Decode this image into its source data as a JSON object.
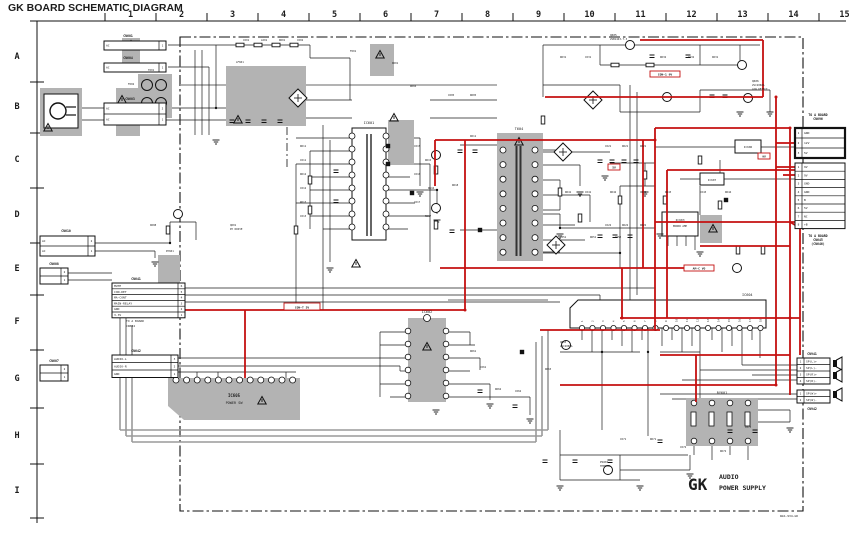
{
  "title": "GK BOARD SCHEMATIC DIAGRAM",
  "grid": {
    "columns": [
      "1",
      "2",
      "3",
      "4",
      "5",
      "6",
      "7",
      "8",
      "9",
      "10",
      "11",
      "12",
      "13",
      "14",
      "15"
    ],
    "rows": [
      "A",
      "B",
      "C",
      "D",
      "E",
      "F",
      "G",
      "H",
      "I"
    ]
  },
  "footer": {
    "board_code": "GK",
    "line1": "AUDIO",
    "line2": "POWER SUPPLY",
    "doc_number": "WGS-934-GK"
  },
  "colors": {
    "red_trace": "#c41111",
    "gray_trace": "#9a9a9a",
    "block_fill": "#b3b3b3",
    "wire": "#1c1c1c",
    "title_ink": "#1a1a40"
  },
  "red_labels": [
    {
      "x": 650,
      "y": 71,
      "w": 30,
      "h": 6,
      "text": "CON-1 9V"
    },
    {
      "x": 284,
      "y": 303,
      "w": 36,
      "h": 7,
      "text": "CON-T 5V"
    },
    {
      "x": 684,
      "y": 265,
      "w": 30,
      "h": 6,
      "text": "AM-C VO"
    },
    {
      "x": 608,
      "y": 164,
      "w": 12,
      "h": 6,
      "text": "5V"
    },
    {
      "x": 758,
      "y": 153,
      "w": 12,
      "h": 6,
      "text": "9V"
    }
  ],
  "connector_boxes": [
    {
      "caption": [
        "CN601"
      ],
      "capx": 128,
      "capy": 37,
      "x": 104,
      "y": 41,
      "w": 62,
      "rh": 9,
      "rows": [
        "AC"
      ],
      "numside": "right",
      "bold": false
    },
    {
      "caption": [
        "CN604"
      ],
      "capx": 128,
      "capy": 59,
      "x": 104,
      "y": 63,
      "w": 62,
      "rh": 9,
      "rows": [
        "AC"
      ],
      "numside": "right",
      "bold": false
    },
    {
      "caption": [
        "CN603"
      ],
      "capx": 130,
      "capy": 100,
      "x": 104,
      "y": 103,
      "w": 62,
      "rh": 11,
      "rows": [
        "AC",
        "AC"
      ],
      "numside": "right",
      "bold": false
    },
    {
      "caption": [
        "CN610"
      ],
      "capx": 66,
      "capy": 232,
      "x": 40,
      "y": 236,
      "w": 55,
      "rh": 10,
      "rows": [
        "AC",
        "AC"
      ],
      "numside": "right",
      "bold": false
    },
    {
      "caption": [
        "CN608"
      ],
      "capx": 54,
      "capy": 265,
      "x": 40,
      "y": 268,
      "w": 28,
      "rh": 8,
      "rows": [
        "",
        ""
      ],
      "numside": "right",
      "bold": false
    },
    {
      "caption": [
        "CN607"
      ],
      "capx": 54,
      "capy": 362,
      "x": 40,
      "y": 365,
      "w": 28,
      "rh": 8,
      "rows": [
        "",
        ""
      ],
      "numside": "right",
      "bold": false
    },
    {
      "caption": [
        "CN641"
      ],
      "capx": 136,
      "capy": 280,
      "x": 112,
      "y": 283,
      "w": 73,
      "rh": 5.8,
      "rows": [
        "MUTE",
        "CON-DET",
        "MA-CONT",
        "MAIN-RELAY",
        "GND",
        "3.3V"
      ],
      "numside": "right",
      "bold": false
    },
    {
      "caption": [
        "CN642"
      ],
      "capx": 136,
      "capy": 352,
      "x": 112,
      "y": 355,
      "w": 66,
      "rh": 7.5,
      "rows": [
        "AUDIO-L",
        "AUDIO-R",
        "GND"
      ],
      "numside": "right",
      "bold": false
    },
    {
      "caption": [
        "TO A BOARD",
        "CN696"
      ],
      "capx": 818,
      "capy": 116,
      "x": 795,
      "y": 128,
      "w": 50,
      "rh": 10,
      "rows": [
        "GND",
        "12V",
        "5V"
      ],
      "numside": "left",
      "bold": true
    },
    {
      "caption": [
        "TO A BOARD",
        "CN645",
        "(CN646)"
      ],
      "capx": 818,
      "capy": 237,
      "x": 795,
      "y": 163,
      "w": 50,
      "rh": 8.2,
      "rows": [
        "9V",
        "9V",
        "GND",
        "GND",
        "B",
        "5V",
        "NC",
        "+B"
      ],
      "numside": "left",
      "bold": false
    },
    {
      "caption": [
        "CN941"
      ],
      "capx": 812,
      "capy": 355,
      "x": 797,
      "y": 358,
      "w": 33,
      "rh": 6.5,
      "rows": [
        "SP(L)+",
        "SP(L)-",
        "SP(R)+",
        "SP(R)-"
      ],
      "numside": "left",
      "bold": false
    },
    {
      "caption": [
        "CN942"
      ],
      "capx": 812,
      "capy": 410,
      "x": 797,
      "y": 390,
      "w": 33,
      "rh": 6.5,
      "rows": [
        "SP(W)+",
        "SP(W)-"
      ],
      "numside": "left",
      "bold": false
    }
  ],
  "part_labels": [
    {
      "x": 126,
      "y": 322,
      "text": "TO A BOARD",
      "size": 3,
      "anchor": "start"
    },
    {
      "x": 126,
      "y": 327,
      "text": "CN644",
      "size": 3,
      "anchor": "start"
    },
    {
      "x": 369,
      "y": 124,
      "text": "IC601",
      "size": 3.5,
      "anchor": "middle"
    },
    {
      "x": 519,
      "y": 130,
      "text": "T604",
      "size": 3.5,
      "anchor": "middle"
    },
    {
      "x": 427,
      "y": 313,
      "text": "IC602",
      "size": 3.5,
      "anchor": "middle"
    },
    {
      "x": 742,
      "y": 296,
      "text": "IC604",
      "size": 3.5,
      "anchor": "start"
    },
    {
      "x": 234,
      "y": 397,
      "text": "IC605",
      "size": 4,
      "anchor": "middle",
      "bold": true
    },
    {
      "x": 234,
      "y": 404,
      "text": "POWER SW",
      "size": 3.5,
      "anchor": "middle"
    },
    {
      "x": 722,
      "y": 394,
      "text": "RY601",
      "size": 3.5,
      "anchor": "middle"
    },
    {
      "x": 680,
      "y": 221,
      "text": "IC603",
      "size": 3,
      "anchor": "middle"
    },
    {
      "x": 680,
      "y": 227,
      "text": "ERROR AMP",
      "size": 2.6,
      "anchor": "middle"
    },
    {
      "x": 748,
      "y": 148,
      "text": "IC606",
      "size": 2.8,
      "anchor": "middle"
    },
    {
      "x": 712,
      "y": 181,
      "text": "IC607",
      "size": 2.8,
      "anchor": "middle"
    },
    {
      "x": 610,
      "y": 36,
      "text": "Q605",
      "size": 2.8,
      "anchor": "start"
    },
    {
      "x": 610,
      "y": 40,
      "text": "2SB1443-7-3",
      "size": 2.6,
      "anchor": "start"
    },
    {
      "x": 752,
      "y": 82,
      "text": "Q606",
      "size": 2.8,
      "anchor": "start"
    },
    {
      "x": 752,
      "y": 86,
      "text": "2SC2060A",
      "size": 2.6,
      "anchor": "start"
    },
    {
      "x": 752,
      "y": 90,
      "text": "LOW DETECT",
      "size": 2.6,
      "anchor": "start"
    },
    {
      "x": 600,
      "y": 463,
      "text": "PS601",
      "size": 2.8,
      "anchor": "start"
    },
    {
      "x": 600,
      "y": 467,
      "text": "THERMAL",
      "size": 2.6,
      "anchor": "start"
    },
    {
      "x": 780,
      "y": 517,
      "text": "WGS-934-GK",
      "size": 3,
      "anchor": "start"
    }
  ],
  "tiny_labels": [
    [
      243,
      41,
      "C601"
    ],
    [
      261,
      41,
      "L601"
    ],
    [
      279,
      41,
      "R601"
    ],
    [
      297,
      41,
      "C602"
    ],
    [
      350,
      52,
      "F601"
    ],
    [
      392,
      64,
      "D601"
    ],
    [
      410,
      87,
      "R604"
    ],
    [
      448,
      96,
      "C605"
    ],
    [
      470,
      96,
      "R605"
    ],
    [
      148,
      71,
      "T601"
    ],
    [
      128,
      85,
      "F602"
    ],
    [
      236,
      63,
      "LF601"
    ],
    [
      300,
      147,
      "R611"
    ],
    [
      300,
      161,
      "C611"
    ],
    [
      300,
      175,
      "R612"
    ],
    [
      300,
      189,
      "C612"
    ],
    [
      300,
      203,
      "R613"
    ],
    [
      300,
      217,
      "C613"
    ],
    [
      414,
      147,
      "C615"
    ],
    [
      425,
      161,
      "R615"
    ],
    [
      414,
      175,
      "C616"
    ],
    [
      428,
      189,
      "R616"
    ],
    [
      414,
      203,
      "C617"
    ],
    [
      425,
      217,
      "R617"
    ],
    [
      470,
      137,
      "D611"
    ],
    [
      452,
      186,
      "R618"
    ],
    [
      605,
      147,
      "C621"
    ],
    [
      622,
      147,
      "R621"
    ],
    [
      640,
      147,
      "D621"
    ],
    [
      605,
      226,
      "C622"
    ],
    [
      622,
      226,
      "R622"
    ],
    [
      640,
      226,
      "D622"
    ],
    [
      560,
      58,
      "R631"
    ],
    [
      585,
      58,
      "C631"
    ],
    [
      660,
      58,
      "R632"
    ],
    [
      688,
      58,
      "C632"
    ],
    [
      712,
      58,
      "D631"
    ],
    [
      565,
      193,
      "R641"
    ],
    [
      585,
      193,
      "C641"
    ],
    [
      610,
      193,
      "R642"
    ],
    [
      640,
      193,
      "C642"
    ],
    [
      665,
      193,
      "R643"
    ],
    [
      700,
      193,
      "C643"
    ],
    [
      725,
      193,
      "R644"
    ],
    [
      560,
      238,
      "C651"
    ],
    [
      590,
      238,
      "R651"
    ],
    [
      615,
      238,
      "C652"
    ],
    [
      470,
      352,
      "R661"
    ],
    [
      480,
      368,
      "C661"
    ],
    [
      495,
      390,
      "R662"
    ],
    [
      515,
      392,
      "C662"
    ],
    [
      545,
      370,
      "R663"
    ],
    [
      560,
      343,
      "Q603"
    ],
    [
      560,
      347,
      "2SC2060A"
    ],
    [
      620,
      440,
      "C671"
    ],
    [
      650,
      440,
      "R671"
    ],
    [
      680,
      448,
      "C672"
    ],
    [
      720,
      452,
      "R672"
    ],
    [
      745,
      428,
      "C673"
    ],
    [
      230,
      226,
      "Q601"
    ],
    [
      230,
      230,
      "RY DRIVE"
    ],
    [
      150,
      226,
      "D608"
    ],
    [
      166,
      252,
      "RY601"
    ]
  ],
  "amp_pins": [
    "1",
    "2",
    "3",
    "4",
    "5",
    "6",
    "7",
    "8",
    "9",
    "10",
    "11",
    "12",
    "13",
    "14",
    "15",
    "16",
    "17",
    "18"
  ]
}
